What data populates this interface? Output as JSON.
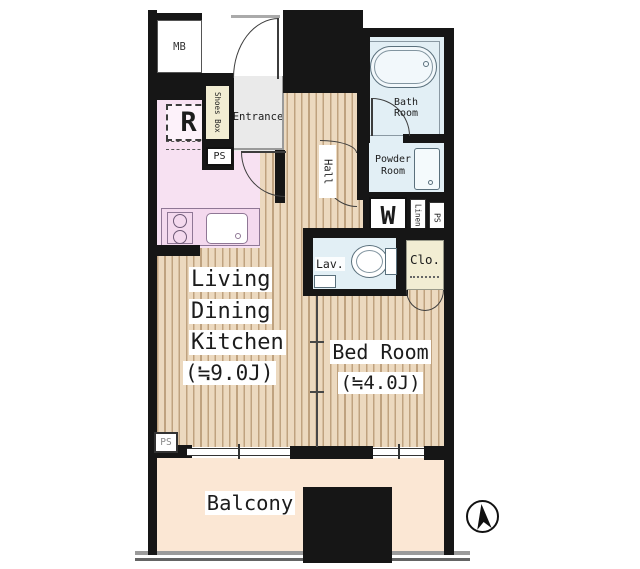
{
  "plan": {
    "title": "apartment-floor-plan",
    "labels": {
      "meter_box": "MB",
      "shoes_box": "Shoes Box",
      "entrance": "Entrance",
      "ps_entrance": "PS",
      "refrigerator": "R",
      "hall": "Hall",
      "bath_1": "Bath",
      "bath_2": "Room",
      "powder_1": "Powder",
      "powder_2": "Room",
      "washer": "W",
      "linen": "Linen",
      "ps_powder": "PS",
      "lav": "Lav.",
      "closet": "Clo.",
      "ldk_1": "Living",
      "ldk_2": "Dining",
      "ldk_3": "Kitchen",
      "ldk_size": "(≒9.0J)",
      "bedroom": "Bed Room",
      "bedroom_size": "(≒4.0J)",
      "ps_ldk": "PS",
      "balcony": "Balcony"
    },
    "colors": {
      "wall": "#161616",
      "wood_base": "#ecd9bf",
      "wood_stripe": "#bfa27f",
      "kitchen": "#f7e1f2",
      "kitchen_counter": "#f4d9ee",
      "wet_rooms_blue": "#e2eff5",
      "closet_cream": "#f2edd3",
      "entrance_gray": "#eaeaea",
      "balcony_peach": "#fbe7d4",
      "railing_gray": "#9b9b9b"
    }
  }
}
